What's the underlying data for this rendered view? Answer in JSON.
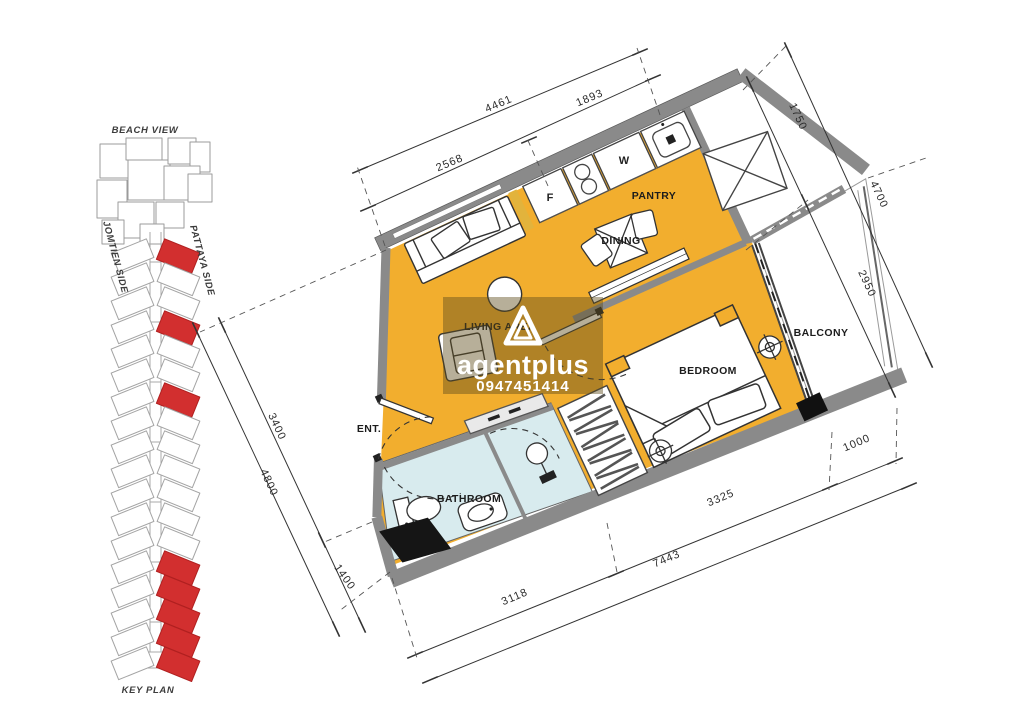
{
  "key_plan": {
    "beach_view_label": "BEACH VIEW",
    "jomtien_label": "JOMTIEN SIDE",
    "pattaya_label": "PATTAYA SIDE",
    "key_plan_label": "KEY PLAN",
    "highlight_color": "#d22f2f"
  },
  "floor_plan": {
    "rooms": {
      "living": "LIVING AREA",
      "pantry": "PANTRY",
      "dining": "DINING",
      "bedroom": "BEDROOM",
      "balcony": "BALCONY",
      "bathroom": "BATHROOM",
      "entrance": "ENT."
    },
    "appliances": {
      "fridge": "F",
      "washer": "W"
    },
    "dimensions": {
      "top_total": "4461",
      "top_right": "1893",
      "top_inner": "2568",
      "right_upper": "1750",
      "right_outer": "4700",
      "right_balcony": "2950",
      "left_upper": "3400",
      "left_outer": "4800",
      "left_lower": "1400",
      "bottom_left": "3118",
      "bottom_outer": "7443",
      "bottom_mid": "3325",
      "bottom_right": "1000"
    },
    "colors": {
      "floor_orange": "#F2AE2E",
      "bathroom_blue": "#D8EBEE",
      "wall_gray": "#8A8A8A",
      "watermark_overlay": "#5F4D1C"
    }
  },
  "watermark": {
    "brand": "agentplus",
    "phone": "0947451414"
  }
}
